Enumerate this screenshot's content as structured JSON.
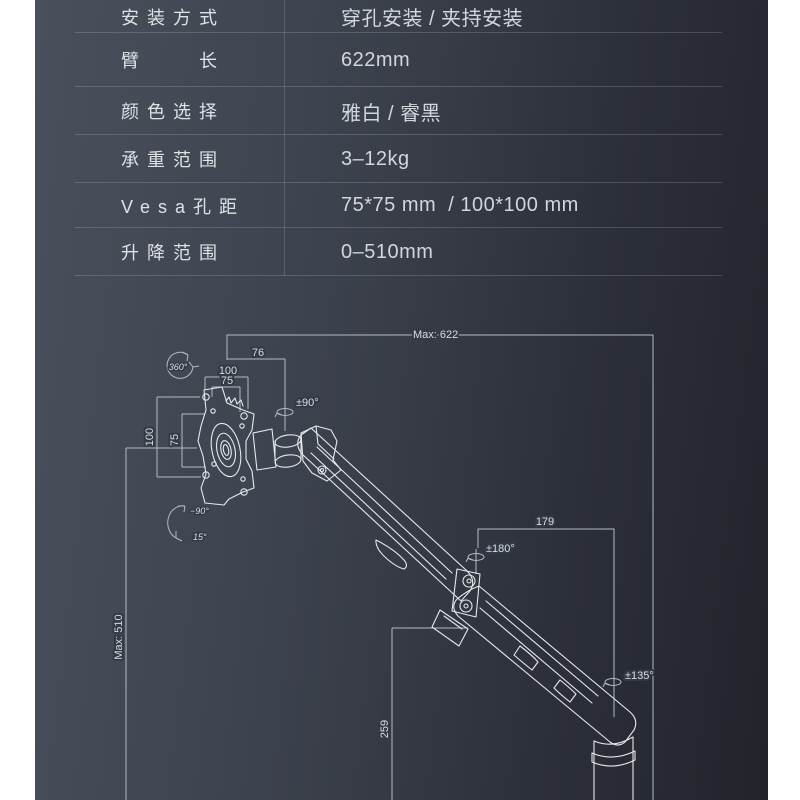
{
  "page": {
    "background": "#ffffff",
    "panel_gradient_start": "#4a505b",
    "panel_gradient_end": "#22242c"
  },
  "spec_table": {
    "rows": [
      {
        "label": "安装方式",
        "value": "穿孔安装 / 夹持安装"
      },
      {
        "label": "臂　　长",
        "value": "622mm"
      },
      {
        "label": "颜色选择",
        "value": "雅白 / 睿黑"
      },
      {
        "label": "承重范围",
        "value": "3–12kg"
      },
      {
        "label": "Vesa孔距",
        "value": "75*75 mm  / 100*100 mm"
      },
      {
        "label": "升降范围",
        "value": "0–510mm"
      }
    ]
  },
  "diagram": {
    "labels": {
      "max_arm_length": "Max: 622",
      "head_offset": "76",
      "vesa_top_100": "100",
      "vesa_top_75": "75",
      "rotate_360": "360°",
      "swivel_90": "±90°",
      "vesa_side_100": "100",
      "vesa_side_75": "75",
      "tilt_down": "−90°",
      "tilt_up": "15°",
      "forearm_179": "179",
      "elbow_180": "±180°",
      "base_135": "±135°",
      "max_lift": "Max: 510",
      "pole_height": "259"
    },
    "colors": {
      "artwork_line": "#e6e9ec",
      "dimension_line": "#b4bac3",
      "label_text": "#d9dde2"
    }
  }
}
